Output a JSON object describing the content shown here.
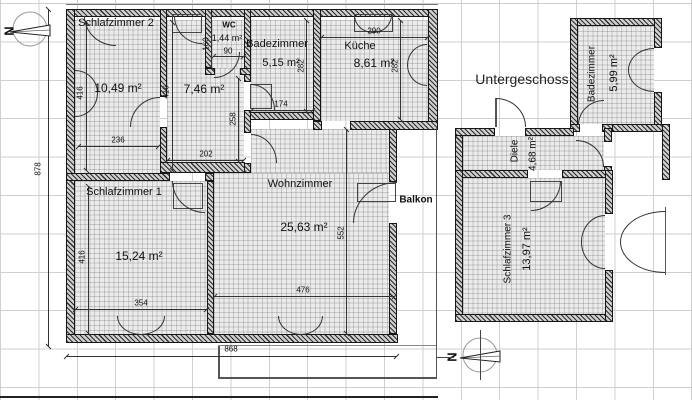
{
  "title": {
    "text": "Untergeschoss"
  },
  "compass": {
    "north_letter": "N"
  },
  "rooms": {
    "schlafzimmer2": {
      "name": "Schlafzimmer 2",
      "area": "10,49 m²"
    },
    "flur": {
      "area": "7,46 m²"
    },
    "wc": {
      "name": "WC",
      "area": "1,44 m²"
    },
    "badezimmer": {
      "name": "Badezimmer",
      "area": "5,15 m²"
    },
    "kueche": {
      "name": "Küche",
      "area": "8,61 m²"
    },
    "wohnzimmer": {
      "name": "Wohnzimmer",
      "area": "25,63 m²"
    },
    "schlafzimmer1": {
      "name": "Schlafzimmer 1",
      "area": "15,24 m²"
    },
    "balkon": {
      "name": "Balkon"
    },
    "badezimmer_ug": {
      "name": "Badezimmer",
      "area": "5,99 m²"
    },
    "diele": {
      "name": "Diele",
      "area": "4,68 m²"
    },
    "schlafzimmer3": {
      "name": "Schlafzimmer 3",
      "area": "13,97 m²"
    }
  },
  "dims": {
    "s2_h": "416",
    "flur_h": "416",
    "s2_w": "236",
    "wc_h": "160",
    "wc_w": "90",
    "bad_w": "174",
    "bad_h": "282",
    "kueche_w": "290",
    "kueche_h": "282",
    "flur_w": "202",
    "flur_lower_h": "258",
    "wohn_h": "552",
    "wohn_w": "476",
    "s1_h": "416",
    "s1_w": "354",
    "total_w": "868",
    "total_h": "878"
  }
}
